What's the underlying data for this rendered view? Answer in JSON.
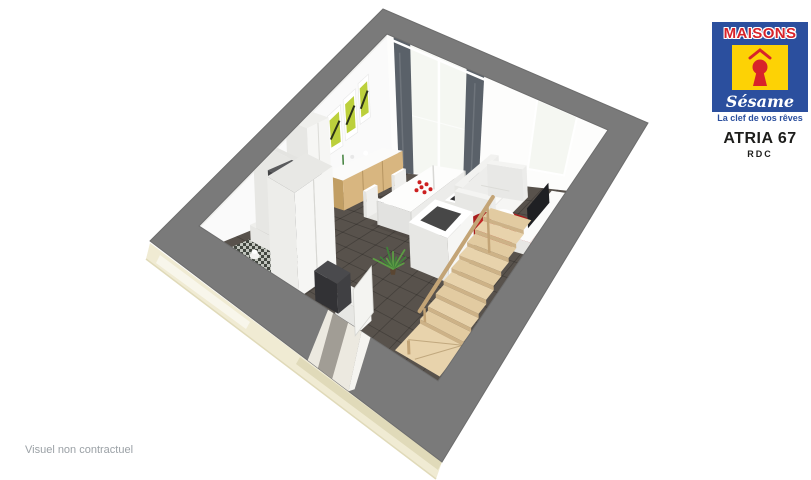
{
  "branding": {
    "logo": {
      "top_text": "MAISONS",
      "script_text": "Sésame",
      "tagline": "La clef de vos rêves",
      "keyhole_icon": "red keyhole with roof caret on yellow square"
    }
  },
  "plan": {
    "model_name": "ATRIA 67",
    "level": "RDC"
  },
  "footer": {
    "disclaimer": "Visuel non contractuel"
  },
  "colors": {
    "logo_blue": "#2b4f9e",
    "logo_yellow": "#fdd205",
    "logo_red": "#d8232a",
    "title_dark": "#1d1d1b",
    "disclaimer_gray": "#9ba1a6"
  },
  "scene": {
    "description": "3D dollhouse cutaway render of ground floor: open living-dining room with staircase, WC, wardrobe and entrance",
    "elements": [
      "exterior-facade",
      "perimeter-wall-top",
      "nw-wall",
      "ne-wall",
      "bay-window",
      "curtains",
      "second-window",
      "wall-art",
      "kitchen-sideboard",
      "tall-cabinet",
      "wc-partition",
      "fridge",
      "wc-checker-floor",
      "toilet",
      "wardrobe",
      "entrance-door",
      "entry-chair",
      "entry-cabinet",
      "dining-table",
      "dining-chairs",
      "red-petals",
      "sofa",
      "red-rug",
      "round-coffee-table",
      "tv-bench",
      "tv",
      "stair-guard-wall",
      "staircase",
      "stair-rail",
      "plant"
    ],
    "colors": {
      "band": "#7a7a7a",
      "band_edge": "#6d6d6d",
      "facade": "#f0ebd3",
      "facade_shade": "#e0dab9",
      "wall": "#fafafa",
      "wall_shade": "#f0f0ee",
      "floor": "#58524c",
      "wc_light": "#c7cbc3",
      "wc_dark": "#41463f",
      "wood": "#d8b680",
      "wood_dark": "#c19e63",
      "stair": "#e8d3ac",
      "stair_alt": "#e2cba1",
      "riser": "#cdb287",
      "rail": "#c3a476",
      "white_furn": "#f6f6f4",
      "white_side": "#e7e7e4",
      "white_top": "#efefec",
      "curtain": "#5a6169",
      "glass": "#f5f7f2",
      "art_green": "#bcd03c",
      "art_dark": "#2c3318",
      "rug": "#a91d1d",
      "rug_hi": "#c22424",
      "dark_obj": "#404043",
      "fridge": "#515254",
      "fridge_dark": "#434446",
      "tv": "#1f2023",
      "plant": "#40803a",
      "plant_hi": "#5d9c44",
      "door": "#f4f4f1",
      "petal": "#cc1f1f"
    }
  }
}
